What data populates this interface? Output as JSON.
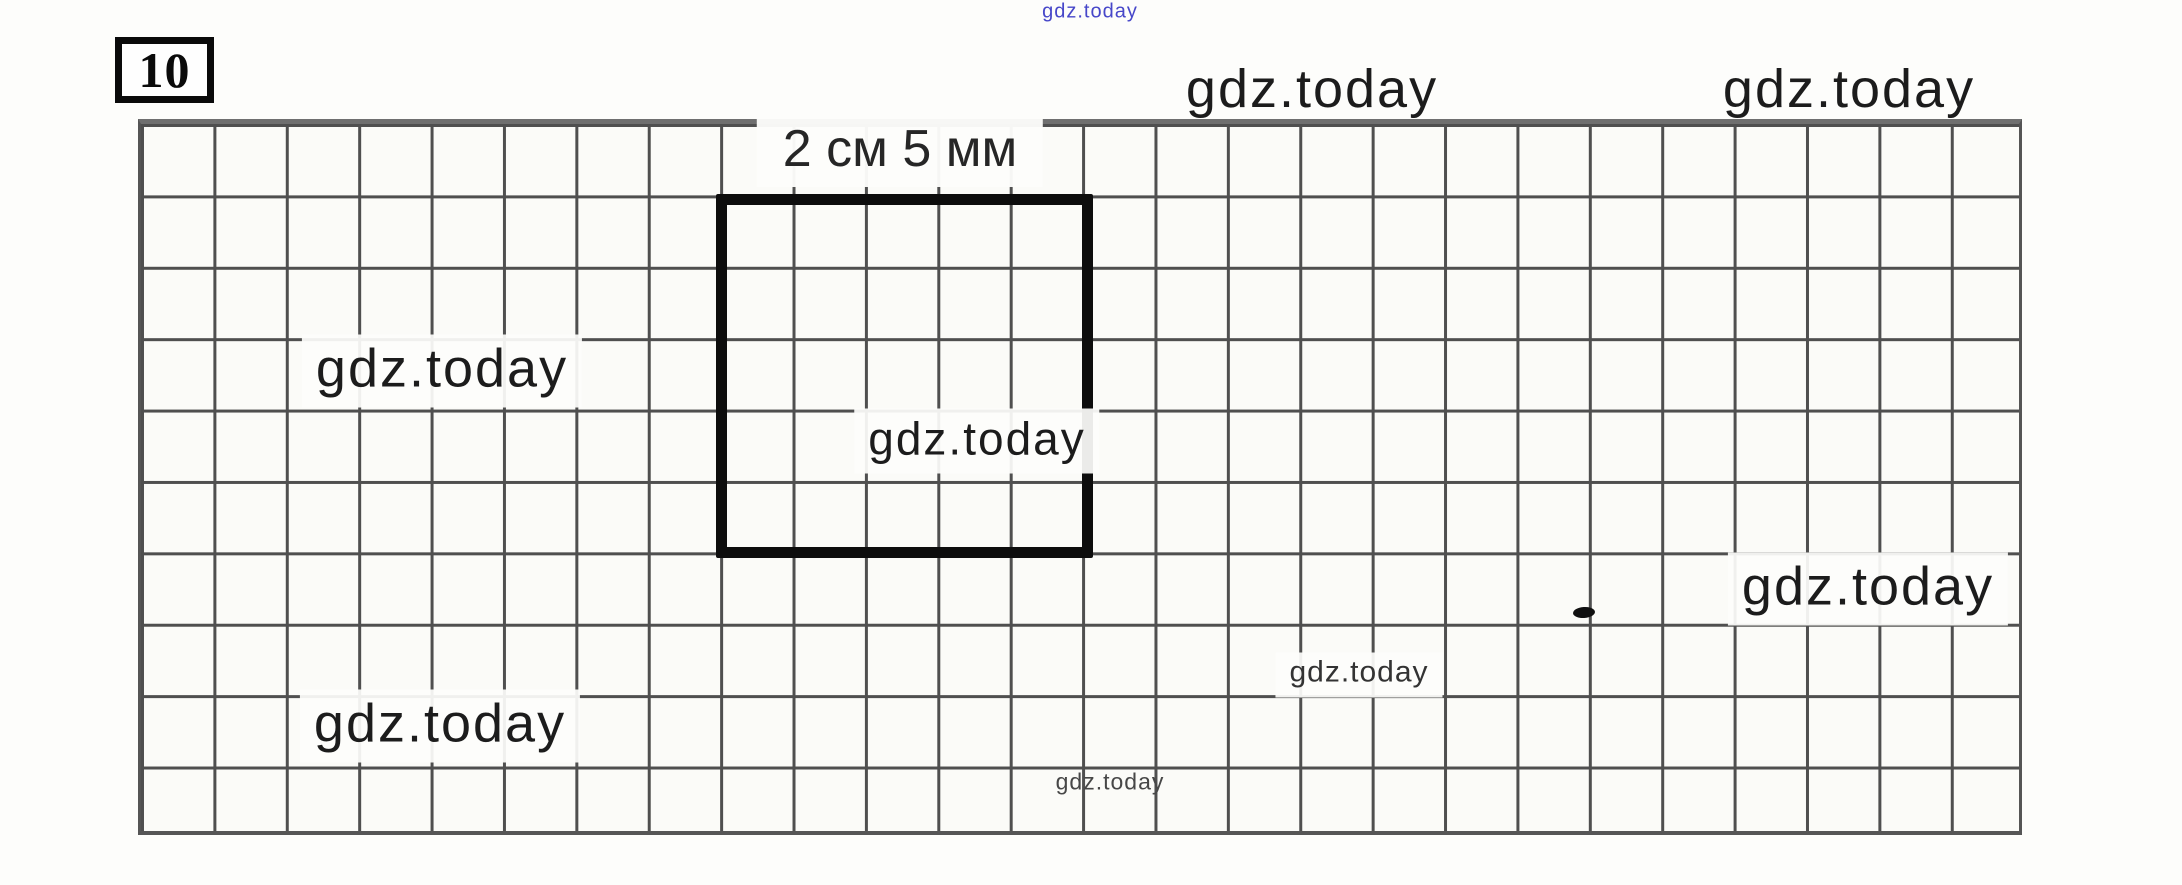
{
  "task": {
    "number": "10"
  },
  "figure": {
    "dimension_label": "2 см 5 мм",
    "shape": "square",
    "square_size_cells": 5,
    "grid_columns": 26,
    "grid_rows": 10
  },
  "watermarks": {
    "top_tiny": "gdz.today",
    "top_right_1": "gdz.today",
    "top_right_2": "gdz.today",
    "left_mid": "gdz.today",
    "center": "gdz.today",
    "right_mid": "gdz.today",
    "small_right": "gdz.today",
    "bottom_left": "gdz.today",
    "bottom_tiny": "gdz.today"
  },
  "colors": {
    "grid_line": "#4f4f4f",
    "square_stroke": "#0d0d0d",
    "watermark_dark": "#1c1c1c",
    "watermark_blue": "#4747c9",
    "paper": "#fdfdfb"
  }
}
